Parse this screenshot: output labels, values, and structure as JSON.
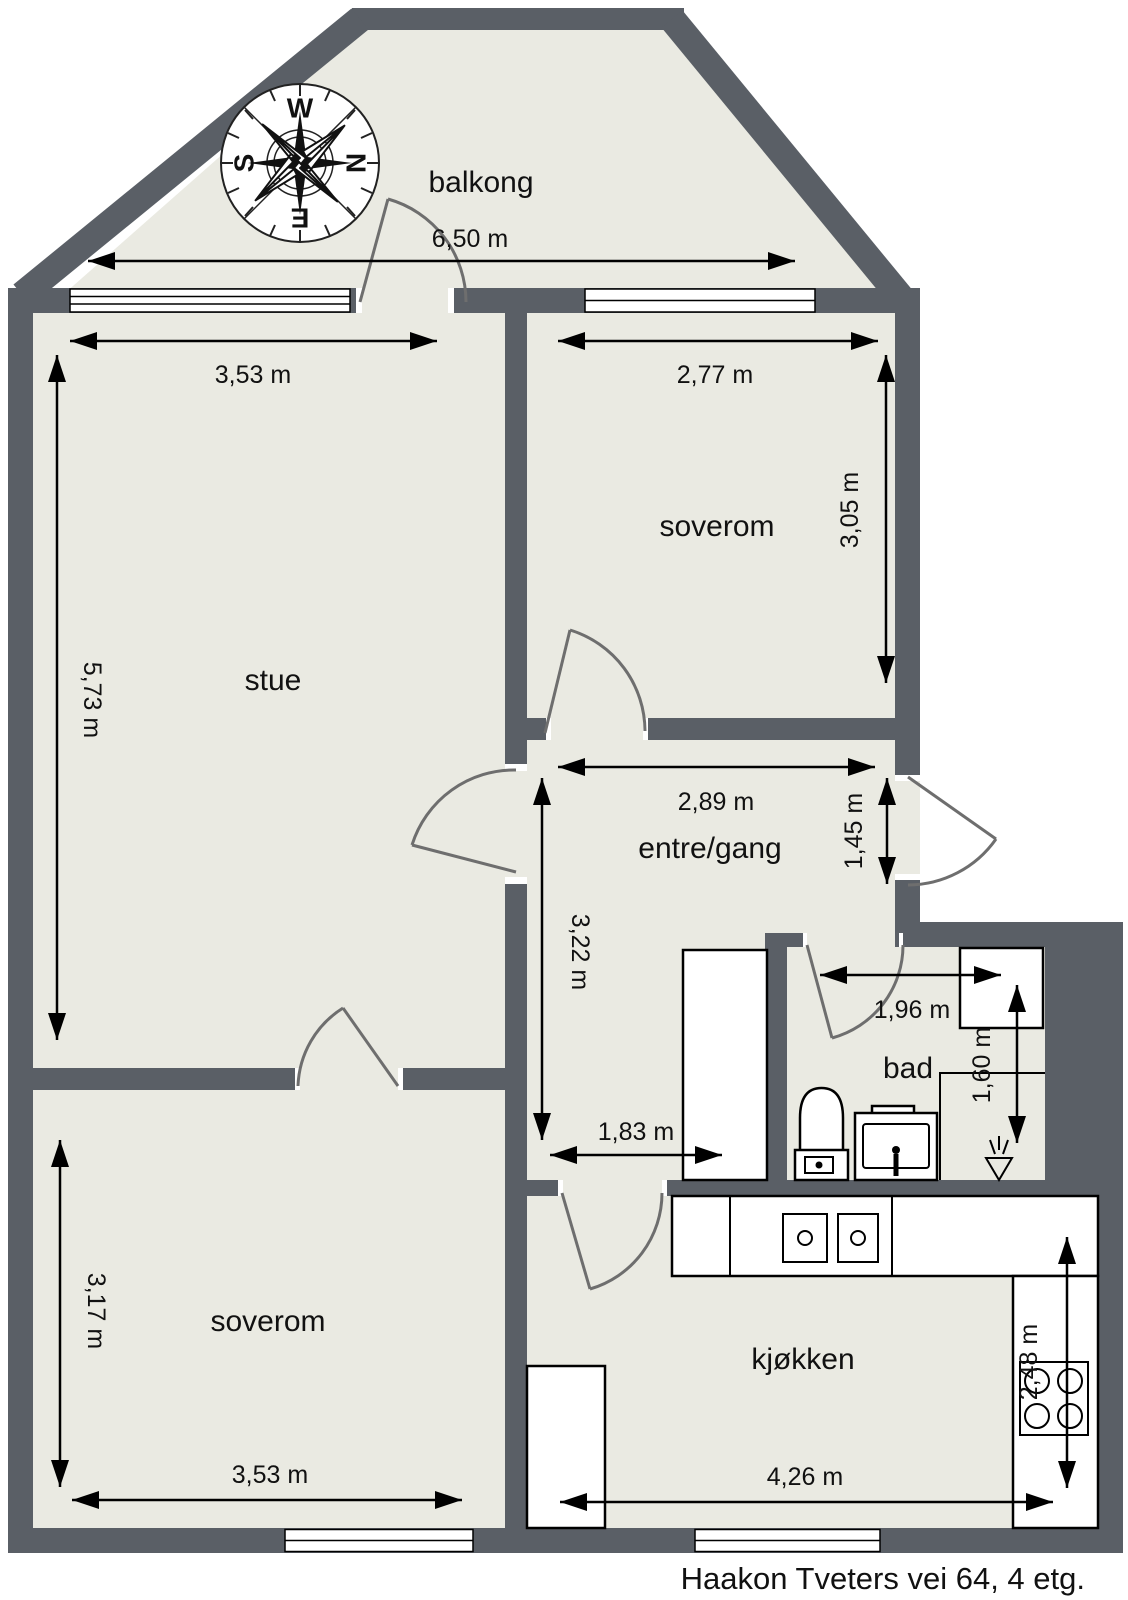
{
  "address_footer": "Haakon Tveters vei 64, 4 etg.",
  "compass": {
    "letters": {
      "w": "W",
      "n": "N",
      "e": "E",
      "s": "S"
    }
  },
  "rooms": [
    {
      "id": "balkong",
      "label": "balkong",
      "width": "6,50 m"
    },
    {
      "id": "stue",
      "label": "stue",
      "width": "3,53 m",
      "height": "5,73 m"
    },
    {
      "id": "soverom-1",
      "label": "soverom",
      "width": "2,77 m",
      "height": "3,05 m"
    },
    {
      "id": "entre",
      "label": "entre/gang",
      "width": "2,89 m",
      "height": "1,45 m",
      "hall_height": "3,22 m",
      "hall_width": "1,83 m"
    },
    {
      "id": "bad",
      "label": "bad",
      "width": "1,96 m",
      "height": "1,60 m"
    },
    {
      "id": "soverom-2",
      "label": "soverom",
      "width": "3,53 m",
      "height": "3,17 m"
    },
    {
      "id": "kjokken",
      "label": "kjøkken",
      "width": "4,26 m",
      "height": "2,48 m"
    }
  ],
  "colors": {
    "wall": "#5a5f66",
    "floor": "#eaeae2",
    "arc": "#6e6e6e",
    "background": "#ffffff",
    "line": "#000000"
  }
}
